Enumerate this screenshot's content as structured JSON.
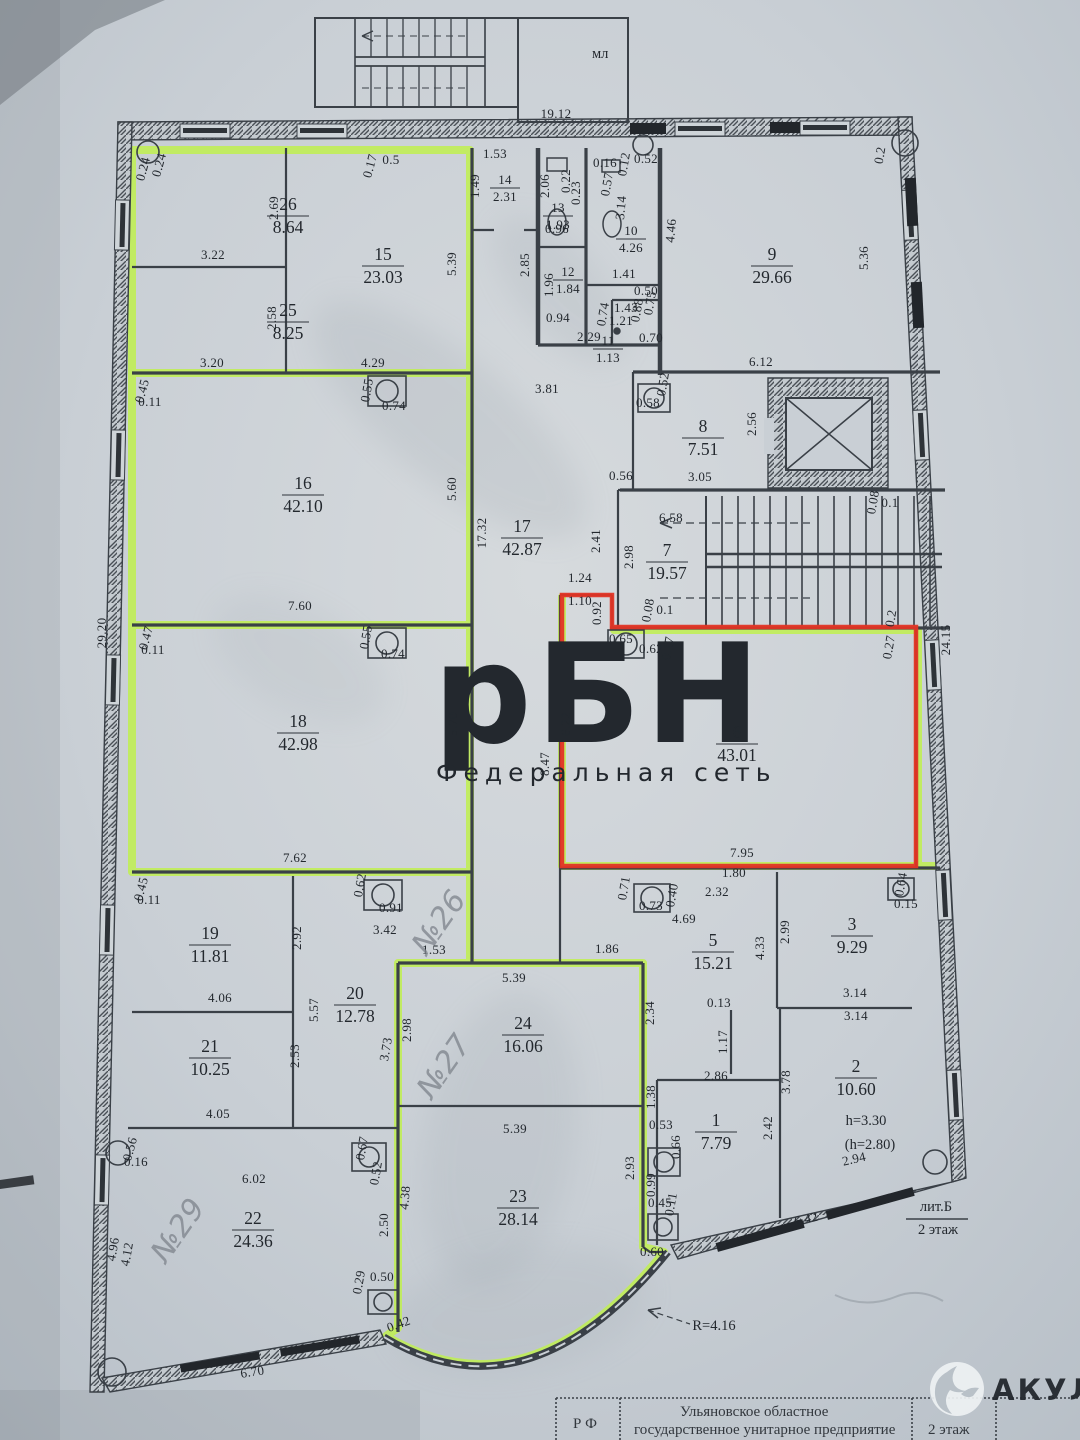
{
  "photo": {
    "paper_color": "#c9cfd5",
    "paper_light": "#d9dde0",
    "line_color": "#3a4047",
    "stain_color": "#8e98a0"
  },
  "highlights": {
    "green": "#c0f04f",
    "red": "#e23425"
  },
  "watermark": {
    "title": "рБН",
    "subtitle": "Федеральная сеть",
    "color": "rgba(214,72,58,0.50)",
    "sub_color": "rgba(214,80,70,0.42)"
  },
  "brand": {
    "name": "АКУЛА"
  },
  "stair_label": "мл",
  "title_block": {
    "left": "Р Ф",
    "line1": "Ульяновское областное",
    "line2": "государственное унитарное предприятие",
    "line3": "бюро технической инвентаризации",
    "right": "2 этаж"
  },
  "annotations": [
    {
      "t": "лит.Б",
      "x": 936,
      "y": 1211
    },
    {
      "t": "2 этаж",
      "x": 938,
      "y": 1234
    },
    {
      "t": "h=3.30",
      "x": 866,
      "y": 1125
    },
    {
      "t": "(h=2.80)",
      "x": 870,
      "y": 1149
    },
    {
      "t": "R=4.16",
      "x": 714,
      "y": 1330
    }
  ],
  "handwritten": [
    {
      "t": "№26",
      "x": 447,
      "y": 928,
      "r": -55
    },
    {
      "t": "№27",
      "x": 452,
      "y": 1072,
      "r": -55
    },
    {
      "t": "№29",
      "x": 186,
      "y": 1236,
      "r": -55
    }
  ],
  "rooms": [
    {
      "n": "26",
      "a": "8.64",
      "x": 288,
      "y": 216
    },
    {
      "n": "25",
      "a": "8.25",
      "x": 288,
      "y": 322
    },
    {
      "n": "15",
      "a": "23.03",
      "x": 383,
      "y": 266
    },
    {
      "n": "16",
      "a": "42.10",
      "x": 303,
      "y": 495
    },
    {
      "n": "17",
      "a": "42.87",
      "x": 522,
      "y": 538
    },
    {
      "n": "18",
      "a": "42.98",
      "x": 298,
      "y": 733
    },
    {
      "n": "14",
      "a": "2.31",
      "x": 505,
      "y": 188,
      "s": 1
    },
    {
      "n": "13",
      "a": "1.93",
      "x": 558,
      "y": 216,
      "s": 1
    },
    {
      "n": "12",
      "a": "1.84",
      "x": 568,
      "y": 280,
      "s": 1
    },
    {
      "n": "10",
      "a": "4.26",
      "x": 631,
      "y": 239,
      "s": 1
    },
    {
      "n": "11",
      "a": "1.13",
      "x": 608,
      "y": 349,
      "s": 1
    },
    {
      "n": "9",
      "a": "29.66",
      "x": 772,
      "y": 266
    },
    {
      "n": "8",
      "a": "7.51",
      "x": 703,
      "y": 438
    },
    {
      "n": "7",
      "a": "19.57",
      "x": 667,
      "y": 562
    },
    {
      "n": "6",
      "a": "43.01",
      "x": 737,
      "y": 744
    },
    {
      "n": "5",
      "a": "15.21",
      "x": 713,
      "y": 952
    },
    {
      "n": "3",
      "a": "9.29",
      "x": 852,
      "y": 936
    },
    {
      "n": "2",
      "a": "10.60",
      "x": 856,
      "y": 1078
    },
    {
      "n": "1",
      "a": "7.79",
      "x": 716,
      "y": 1132
    },
    {
      "n": "19",
      "a": "11.81",
      "x": 210,
      "y": 945
    },
    {
      "n": "20",
      "a": "12.78",
      "x": 355,
      "y": 1005
    },
    {
      "n": "21",
      "a": "10.25",
      "x": 210,
      "y": 1058
    },
    {
      "n": "24",
      "a": "16.06",
      "x": 523,
      "y": 1035
    },
    {
      "n": "23",
      "a": "28.14",
      "x": 518,
      "y": 1208
    },
    {
      "n": "22",
      "a": "24.36",
      "x": 253,
      "y": 1230
    }
  ],
  "dims": [
    {
      "t": "19.12",
      "x": 556,
      "y": 118
    },
    {
      "t": "1.53",
      "x": 495,
      "y": 158
    },
    {
      "t": "1.49",
      "x": 479,
      "y": 186,
      "r": -90
    },
    {
      "t": "0.17",
      "x": 374,
      "y": 167,
      "r": -75
    },
    {
      "t": "0.5",
      "x": 391,
      "y": 164
    },
    {
      "t": "0.24",
      "x": 147,
      "y": 170,
      "r": -75
    },
    {
      "t": "0.24",
      "x": 163,
      "y": 166,
      "r": -75
    },
    {
      "t": "2.06",
      "x": 549,
      "y": 186,
      "r": -90
    },
    {
      "t": "0.22",
      "x": 570,
      "y": 181,
      "r": -90
    },
    {
      "t": "0.23",
      "x": 580,
      "y": 193,
      "r": -90
    },
    {
      "t": "0.16",
      "x": 605,
      "y": 167
    },
    {
      "t": "0.12",
      "x": 628,
      "y": 165,
      "r": -80
    },
    {
      "t": "0.52",
      "x": 646,
      "y": 163
    },
    {
      "t": "0.57",
      "x": 611,
      "y": 185,
      "r": -80
    },
    {
      "t": "3.14",
      "x": 625,
      "y": 208,
      "r": -85
    },
    {
      "t": "4.46",
      "x": 675,
      "y": 231,
      "r": -85
    },
    {
      "t": "1.41",
      "x": 624,
      "y": 278
    },
    {
      "t": "0.96",
      "x": 557,
      "y": 233
    },
    {
      "t": "1.96",
      "x": 553,
      "y": 285,
      "r": -90
    },
    {
      "t": "2.85",
      "x": 529,
      "y": 265,
      "r": -90
    },
    {
      "t": "0.94",
      "x": 558,
      "y": 322
    },
    {
      "t": "2.29",
      "x": 589,
      "y": 341
    },
    {
      "t": "0.70",
      "x": 651,
      "y": 342
    },
    {
      "t": "0.74",
      "x": 607,
      "y": 315,
      "r": -80
    },
    {
      "t": "1.43",
      "x": 626,
      "y": 312
    },
    {
      "t": "1.21",
      "x": 621,
      "y": 325
    },
    {
      "t": "0.88",
      "x": 641,
      "y": 311,
      "r": -80
    },
    {
      "t": "0.75",
      "x": 654,
      "y": 304,
      "r": -80
    },
    {
      "t": "0.50",
      "x": 646,
      "y": 295
    },
    {
      "t": "0.2",
      "x": 884,
      "y": 156,
      "r": -80
    },
    {
      "t": "5.36",
      "x": 868,
      "y": 258,
      "r": -90
    },
    {
      "t": "6.12",
      "x": 761,
      "y": 366
    },
    {
      "t": "2.69",
      "x": 278,
      "y": 208,
      "r": -90
    },
    {
      "t": "3.22",
      "x": 213,
      "y": 259
    },
    {
      "t": "2.58",
      "x": 276,
      "y": 318,
      "r": -90
    },
    {
      "t": "3.20",
      "x": 212,
      "y": 367
    },
    {
      "t": "5.39",
      "x": 456,
      "y": 264,
      "r": -90
    },
    {
      "t": "4.29",
      "x": 373,
      "y": 367
    },
    {
      "t": "0.45",
      "x": 146,
      "y": 392,
      "r": -75
    },
    {
      "t": "0.11",
      "x": 150,
      "y": 406
    },
    {
      "t": "0.55",
      "x": 371,
      "y": 391,
      "r": -80
    },
    {
      "t": "0.74",
      "x": 394,
      "y": 410
    },
    {
      "t": "5.60",
      "x": 456,
      "y": 489,
      "r": -90
    },
    {
      "t": "17.32",
      "x": 486,
      "y": 533,
      "r": -90
    },
    {
      "t": "7.60",
      "x": 300,
      "y": 610
    },
    {
      "t": "29.20",
      "x": 106,
      "y": 633,
      "r": -90
    },
    {
      "t": "0.47",
      "x": 150,
      "y": 639,
      "r": -75
    },
    {
      "t": "0.11",
      "x": 153,
      "y": 654
    },
    {
      "t": "0.55",
      "x": 370,
      "y": 638,
      "r": -80
    },
    {
      "t": "0.74",
      "x": 393,
      "y": 658
    },
    {
      "t": "5.70",
      "x": 457,
      "y": 724,
      "r": -90
    },
    {
      "t": "7.62",
      "x": 295,
      "y": 862
    },
    {
      "t": "0.45",
      "x": 145,
      "y": 890,
      "r": -75
    },
    {
      "t": "0.11",
      "x": 149,
      "y": 904
    },
    {
      "t": "0.62",
      "x": 364,
      "y": 886,
      "r": -80
    },
    {
      "t": "0.91",
      "x": 391,
      "y": 912
    },
    {
      "t": "3.81",
      "x": 547,
      "y": 393
    },
    {
      "t": "0.58",
      "x": 648,
      "y": 407
    },
    {
      "t": "0.52",
      "x": 667,
      "y": 385,
      "r": -80
    },
    {
      "t": "2.56",
      "x": 756,
      "y": 424,
      "r": -90
    },
    {
      "t": "3.05",
      "x": 700,
      "y": 481
    },
    {
      "t": "0.56",
      "x": 621,
      "y": 480
    },
    {
      "t": "6.58",
      "x": 671,
      "y": 522
    },
    {
      "t": "2.41",
      "x": 600,
      "y": 541,
      "r": -90
    },
    {
      "t": "2.98",
      "x": 633,
      "y": 557,
      "r": -90
    },
    {
      "t": "0.08",
      "x": 877,
      "y": 503,
      "r": -80
    },
    {
      "t": "0.1",
      "x": 890,
      "y": 507
    },
    {
      "t": "1.24",
      "x": 580,
      "y": 582
    },
    {
      "t": "1.10",
      "x": 580,
      "y": 605
    },
    {
      "t": "0.92",
      "x": 601,
      "y": 613,
      "r": -90
    },
    {
      "t": "0.65",
      "x": 621,
      "y": 643
    },
    {
      "t": "0.62",
      "x": 651,
      "y": 653
    },
    {
      "t": "0.17",
      "x": 672,
      "y": 649,
      "r": -80
    },
    {
      "t": "0.08",
      "x": 652,
      "y": 611,
      "r": -80
    },
    {
      "t": "0.1",
      "x": 665,
      "y": 614
    },
    {
      "t": "0.2",
      "x": 895,
      "y": 619,
      "r": -80
    },
    {
      "t": "0.27",
      "x": 893,
      "y": 648,
      "r": -80
    },
    {
      "t": "24.15",
      "x": 950,
      "y": 640,
      "r": -90
    },
    {
      "t": "6.22",
      "x": 570,
      "y": 724,
      "r": -90
    },
    {
      "t": "8.47",
      "x": 549,
      "y": 764,
      "r": -90
    },
    {
      "t": "7.95",
      "x": 742,
      "y": 857
    },
    {
      "t": "1.80",
      "x": 734,
      "y": 877
    },
    {
      "t": "0.71",
      "x": 628,
      "y": 889,
      "r": -80
    },
    {
      "t": "0.73",
      "x": 651,
      "y": 910
    },
    {
      "t": "0.40",
      "x": 676,
      "y": 896,
      "r": -80
    },
    {
      "t": "2.32",
      "x": 717,
      "y": 896
    },
    {
      "t": "4.69",
      "x": 684,
      "y": 923
    },
    {
      "t": "1.86",
      "x": 607,
      "y": 953
    },
    {
      "t": "1.53",
      "x": 434,
      "y": 954
    },
    {
      "t": "0.64",
      "x": 905,
      "y": 885,
      "r": -80
    },
    {
      "t": "0.15",
      "x": 906,
      "y": 908
    },
    {
      "t": "2.99",
      "x": 789,
      "y": 932,
      "r": -90
    },
    {
      "t": "4.33",
      "x": 764,
      "y": 948,
      "r": -90
    },
    {
      "t": "3.14",
      "x": 855,
      "y": 997
    },
    {
      "t": "3.14",
      "x": 856,
      "y": 1020
    },
    {
      "t": "2.92",
      "x": 301,
      "y": 938,
      "r": -90
    },
    {
      "t": "3.42",
      "x": 385,
      "y": 934
    },
    {
      "t": "4.06",
      "x": 220,
      "y": 1002
    },
    {
      "t": "5.57",
      "x": 318,
      "y": 1010,
      "r": -90
    },
    {
      "t": "2.53",
      "x": 299,
      "y": 1056,
      "r": -90
    },
    {
      "t": "3.73",
      "x": 390,
      "y": 1050,
      "r": -80
    },
    {
      "t": "2.98",
      "x": 411,
      "y": 1030,
      "r": -90
    },
    {
      "t": "5.39",
      "x": 514,
      "y": 982
    },
    {
      "t": "2.34",
      "x": 654,
      "y": 1013,
      "r": -90
    },
    {
      "t": "0.13",
      "x": 719,
      "y": 1007
    },
    {
      "t": "1.17",
      "x": 727,
      "y": 1042,
      "r": -90
    },
    {
      "t": "2.86",
      "x": 716,
      "y": 1080
    },
    {
      "t": "3.78",
      "x": 790,
      "y": 1082,
      "r": -90
    },
    {
      "t": "4.05",
      "x": 218,
      "y": 1118
    },
    {
      "t": "1.38",
      "x": 655,
      "y": 1097,
      "r": -90
    },
    {
      "t": "0.53",
      "x": 661,
      "y": 1129
    },
    {
      "t": "0.66",
      "x": 680,
      "y": 1147,
      "r": -90
    },
    {
      "t": "5.39",
      "x": 515,
      "y": 1133
    },
    {
      "t": "2.42",
      "x": 772,
      "y": 1128,
      "r": -90
    },
    {
      "t": "0.56",
      "x": 134,
      "y": 1150,
      "r": -75
    },
    {
      "t": "0.16",
      "x": 136,
      "y": 1166
    },
    {
      "t": "6.02",
      "x": 254,
      "y": 1183
    },
    {
      "t": "0.67",
      "x": 366,
      "y": 1149,
      "r": -80
    },
    {
      "t": "0.52",
      "x": 380,
      "y": 1174,
      "r": -80
    },
    {
      "t": "2.50",
      "x": 388,
      "y": 1225,
      "r": -90
    },
    {
      "t": "4.38",
      "x": 409,
      "y": 1198,
      "r": -85
    },
    {
      "t": "2.93",
      "x": 634,
      "y": 1168,
      "r": -90
    },
    {
      "t": "0.99",
      "x": 655,
      "y": 1185,
      "r": -90
    },
    {
      "t": "0.45",
      "x": 660,
      "y": 1207
    },
    {
      "t": "0.11",
      "x": 675,
      "y": 1205,
      "r": -80
    },
    {
      "t": "0.29",
      "x": 363,
      "y": 1283,
      "r": -80
    },
    {
      "t": "0.50",
      "x": 382,
      "y": 1281
    },
    {
      "t": "0.42",
      "x": 400,
      "y": 1328,
      "r": -20
    },
    {
      "t": "0.60",
      "x": 652,
      "y": 1256
    },
    {
      "t": "4.96",
      "x": 117,
      "y": 1250,
      "r": -80
    },
    {
      "t": "4.12",
      "x": 131,
      "y": 1255,
      "r": -80
    },
    {
      "t": "6.70",
      "x": 253,
      "y": 1376,
      "r": -9
    },
    {
      "t": "6.42",
      "x": 807,
      "y": 1223,
      "r": -13
    },
    {
      "t": "2.94",
      "x": 855,
      "y": 1163,
      "r": -13
    }
  ]
}
